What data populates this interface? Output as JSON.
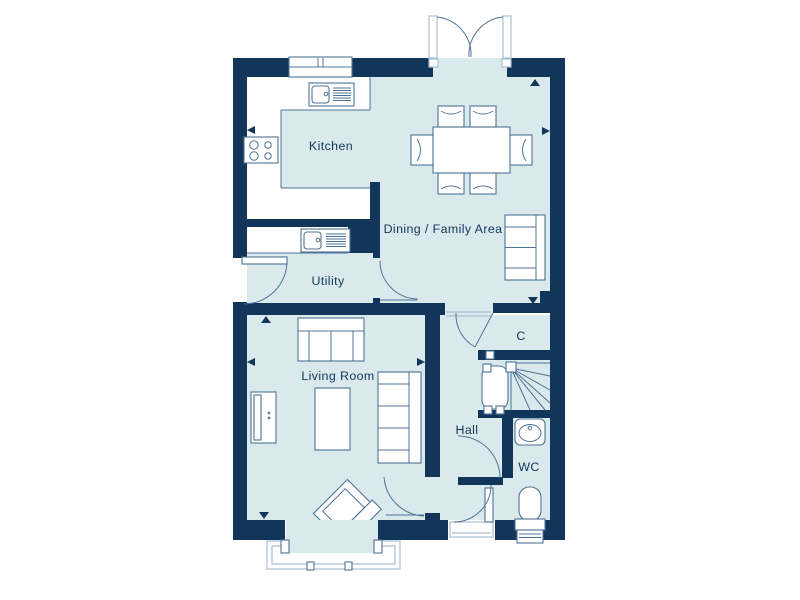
{
  "plan": {
    "rooms": {
      "kitchen": "Kitchen",
      "dining": "Dining / Family Area",
      "utility": "Utility",
      "living": "Living Room",
      "hall": "Hall",
      "closet": "C",
      "wc": "WC"
    }
  },
  "colors": {
    "wall": "#12365a",
    "floor": "#d9e9ec",
    "line": "#4f7396",
    "frame": "#a9bfd2",
    "text": "#12365a",
    "background": "#ffffff"
  }
}
